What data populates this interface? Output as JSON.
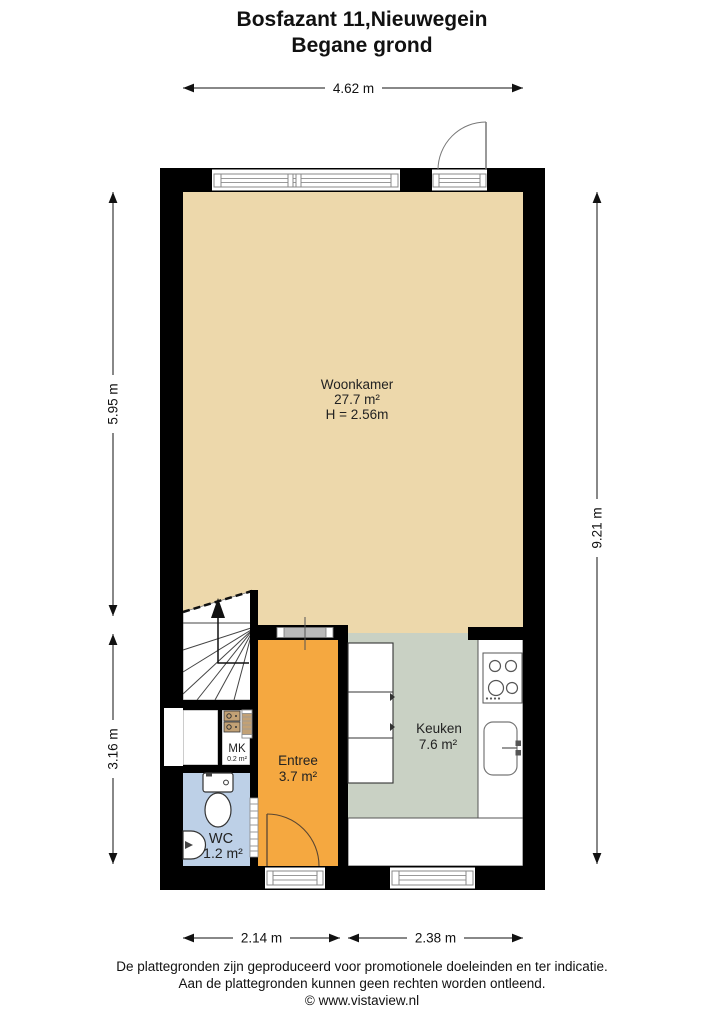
{
  "title": {
    "line1": "Bosfazant 11,Nieuwegein",
    "line2": "Begane grond"
  },
  "rooms": {
    "woonkamer": {
      "name": "Woonkamer",
      "area": "27.7 m²",
      "ceiling_height": "H = 2.56m"
    },
    "entree": {
      "name": "Entree",
      "area": "3.7 m²"
    },
    "keuken": {
      "name": "Keuken",
      "area": "7.6 m²"
    },
    "wc": {
      "name": "WC",
      "area": "1.2 m²"
    },
    "mk": {
      "name": "MK",
      "area": "0.2 m²"
    }
  },
  "dimensions": {
    "top_width": "4.62 m",
    "left_upper": "5.95 m",
    "left_lower": "3.16 m",
    "right_total": "9.21 m",
    "bottom_left": "2.14 m",
    "bottom_right": "2.38 m"
  },
  "footer": {
    "line1": "De plattegronden zijn geproduceerd voor promotionele doeleinden en ter indicatie.",
    "line2": "Aan de plattegronden kunnen geen rechten worden ontleend.",
    "line3": "© www.vistaview.nl"
  },
  "colors": {
    "woonkamer": "#EDD8AB",
    "entree": "#F5A840",
    "keuken": "#C9D1C4",
    "wc": "#BDD0E7",
    "wall": "#000000",
    "mk_door": "#C2A175"
  }
}
